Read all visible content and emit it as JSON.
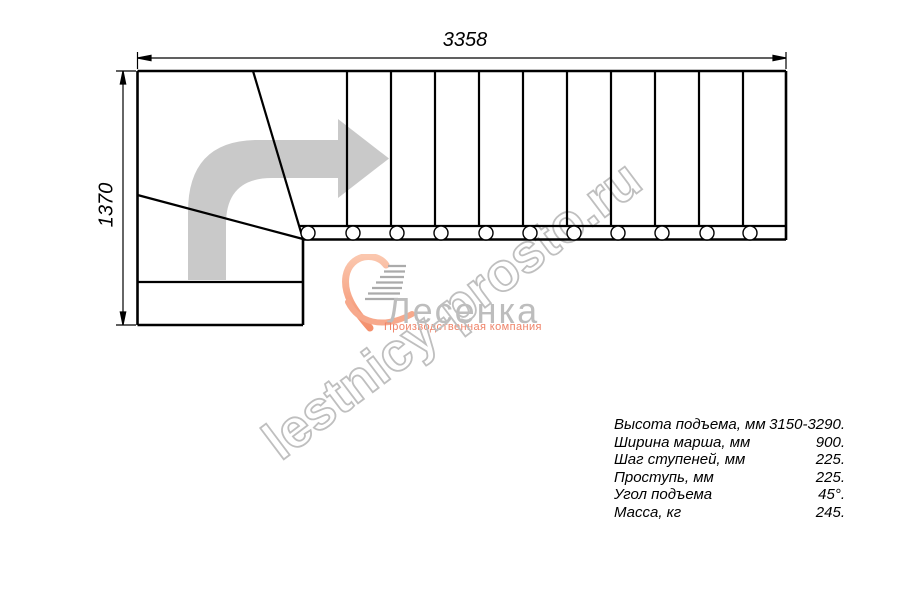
{
  "dimensions": {
    "width_mm": "3358",
    "height_mm": "1370"
  },
  "watermark": {
    "text": "lestnicy-prosto.ru",
    "color": "#bfbfbf"
  },
  "logo": {
    "company": "Лесенка",
    "tagline": "Производственная компания",
    "accent_color": "#f4906d",
    "name_color": "#bdbdbd"
  },
  "specs": [
    {
      "label": "Высота подъема, мм",
      "value": "3150-3290."
    },
    {
      "label": "Ширина марша, мм",
      "value": "900."
    },
    {
      "label": "Шаг ступеней, мм",
      "value": "225."
    },
    {
      "label": "Проступь, мм",
      "value": "225."
    },
    {
      "label": "Угол подъема",
      "value": "45°."
    },
    {
      "label": "Масса, кг",
      "value": "245."
    }
  ],
  "drawing": {
    "straight_treads_count": "10",
    "line_color": "#000000",
    "arrow_color": "#c9c9c9"
  }
}
